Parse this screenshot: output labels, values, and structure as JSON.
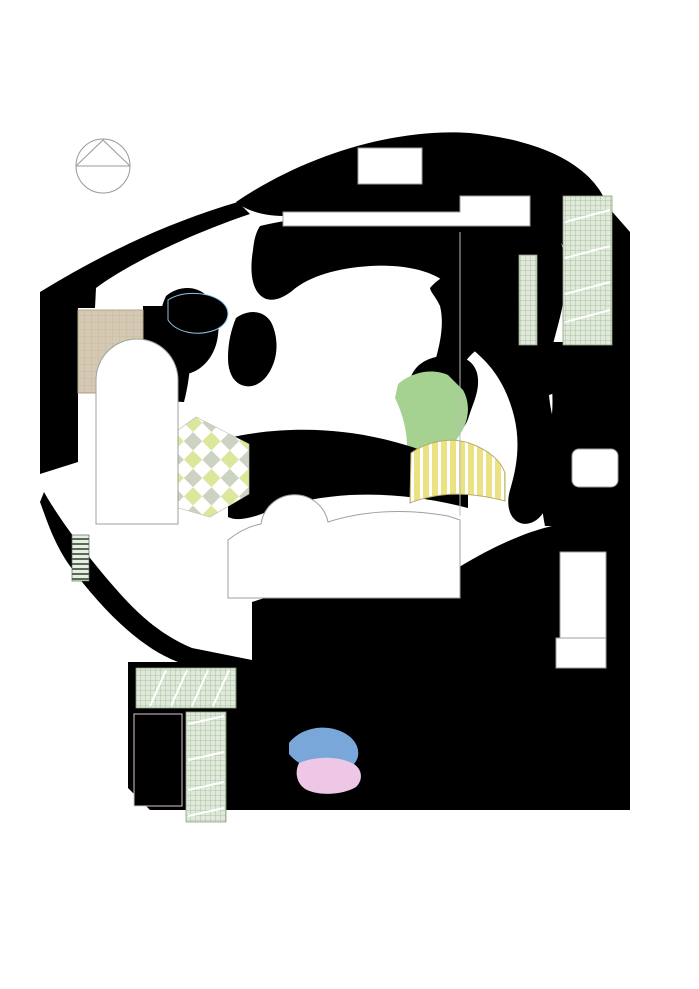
{
  "compass": {
    "label": "N"
  },
  "colors": {
    "lawn": "#d8edc2",
    "lawn2": "#e3f2d2",
    "pink": "#e9c2e2",
    "pink_light": "#f4e4f0",
    "salmon": "#e8aba0",
    "brick": "#b4756b",
    "blue": "#6f9ed6",
    "blue_light": "#bfe2f6",
    "green_band": "#b5d9a0",
    "yellow_pale": "#f4f0ba",
    "yellow_stripe": "#ece284",
    "orange_steps": "#e8b06e",
    "sand": "#d8c9a2",
    "plaza_gray": "#d8d2c5",
    "road": "#b4b4b4",
    "tree_fill": "#cfe763",
    "tree_stroke": "#7f923b",
    "shrub_fill": "#7cc144",
    "shrub_stroke": "#4a7d26",
    "bush_fill": "#5aa636",
    "car_green": "#33512f",
    "car_red": "#8c3c34",
    "car_white": "#f3f3f3"
  },
  "trees": [
    [
      252,
      186,
      21
    ],
    [
      216,
      198,
      21
    ],
    [
      182,
      212,
      21
    ],
    [
      149,
      228,
      21
    ],
    [
      117,
      244,
      21
    ],
    [
      86,
      260,
      20
    ],
    [
      57,
      277,
      20
    ],
    [
      44,
      308,
      20
    ],
    [
      42,
      346,
      20
    ],
    [
      41,
      384,
      20
    ],
    [
      42,
      422,
      20
    ],
    [
      45,
      459,
      20
    ],
    [
      50,
      494,
      20
    ],
    [
      63,
      524,
      19
    ],
    [
      82,
      553,
      19
    ],
    [
      103,
      581,
      19
    ],
    [
      125,
      607,
      19
    ],
    [
      147,
      632,
      18
    ],
    [
      176,
      642,
      15
    ],
    [
      204,
      649,
      15
    ],
    [
      240,
      666,
      16
    ],
    [
      260,
      703,
      17
    ],
    [
      288,
      171,
      22
    ],
    [
      325,
      158,
      22
    ],
    [
      362,
      148,
      22
    ],
    [
      400,
      141,
      22
    ],
    [
      438,
      138,
      22
    ],
    [
      476,
      141,
      22
    ],
    [
      512,
      150,
      21
    ],
    [
      545,
      164,
      21
    ],
    [
      574,
      183,
      20
    ],
    [
      597,
      207,
      19
    ],
    [
      615,
      232,
      14
    ],
    [
      617,
      257,
      14
    ],
    [
      618,
      282,
      14
    ],
    [
      619,
      307,
      14
    ],
    [
      620,
      331,
      14
    ],
    [
      620,
      357,
      16
    ],
    [
      620,
      383,
      16
    ],
    [
      619,
      409,
      16
    ],
    [
      617,
      435,
      16
    ],
    [
      615,
      461,
      16
    ],
    [
      613,
      487,
      16
    ],
    [
      611,
      513,
      16
    ],
    [
      616,
      560,
      18
    ],
    [
      618,
      586,
      18
    ],
    [
      620,
      612,
      18
    ],
    [
      621,
      637,
      18
    ],
    [
      620,
      663,
      18
    ],
    [
      618,
      688,
      18
    ],
    [
      630,
      724,
      18
    ],
    [
      642,
      756,
      18
    ],
    [
      652,
      788,
      18
    ],
    [
      243,
      807,
      19
    ],
    [
      281,
      807,
      19
    ],
    [
      319,
      807,
      19
    ],
    [
      357,
      807,
      19
    ],
    [
      395,
      807,
      19
    ],
    [
      433,
      807,
      19
    ],
    [
      471,
      807,
      19
    ],
    [
      509,
      807,
      19
    ],
    [
      547,
      807,
      19
    ],
    [
      585,
      807,
      19
    ],
    [
      621,
      806,
      19
    ],
    [
      155,
      856,
      20
    ],
    [
      193,
      856,
      20
    ],
    [
      231,
      856,
      20
    ],
    [
      269,
      856,
      20
    ],
    [
      307,
      856,
      20
    ],
    [
      345,
      856,
      20
    ],
    [
      383,
      856,
      20
    ],
    [
      421,
      856,
      20
    ],
    [
      459,
      856,
      20
    ],
    [
      497,
      856,
      20
    ],
    [
      535,
      856,
      20
    ],
    [
      573,
      856,
      20
    ],
    [
      611,
      856,
      20
    ],
    [
      648,
      857,
      20
    ],
    [
      627,
      884,
      16
    ],
    [
      37,
      668,
      16
    ],
    [
      30,
      704,
      16
    ],
    [
      28,
      740,
      16
    ],
    [
      31,
      776,
      16
    ],
    [
      52,
      800,
      16
    ],
    [
      78,
      823,
      17
    ],
    [
      105,
      842,
      17
    ],
    [
      130,
      852,
      17
    ]
  ],
  "shrubs": [
    [
      342,
      170,
      9
    ],
    [
      357,
      166,
      9
    ],
    [
      450,
      171,
      9
    ],
    [
      462,
      164,
      10
    ],
    [
      477,
      168,
      9
    ],
    [
      283,
      194,
      8
    ],
    [
      281,
      204,
      8
    ],
    [
      148,
      257,
      8
    ],
    [
      152,
      268,
      8
    ],
    [
      142,
      305,
      8
    ],
    [
      147,
      322,
      9
    ],
    [
      160,
      347,
      10
    ],
    [
      147,
      344,
      9
    ],
    [
      149,
      361,
      9
    ],
    [
      161,
      363,
      9
    ],
    [
      157,
      379,
      9
    ],
    [
      160,
      392,
      9
    ],
    [
      102,
      531,
      10
    ],
    [
      102,
      551,
      10
    ],
    [
      100,
      567,
      10
    ],
    [
      100,
      585,
      10
    ],
    [
      143,
      713,
      9
    ],
    [
      180,
      719,
      9
    ],
    [
      181,
      744,
      9
    ],
    [
      180,
      769,
      9
    ],
    [
      181,
      792,
      9
    ],
    [
      142,
      808,
      9
    ],
    [
      317,
      383,
      8
    ],
    [
      328,
      367,
      8
    ],
    [
      390,
      387,
      9
    ],
    [
      403,
      370,
      8
    ],
    [
      402,
      421,
      9
    ],
    [
      392,
      408,
      8
    ],
    [
      382,
      442,
      9
    ],
    [
      363,
      449,
      9
    ],
    [
      350,
      447,
      8
    ],
    [
      332,
      454,
      9
    ],
    [
      318,
      444,
      8
    ],
    [
      407,
      455,
      8
    ],
    [
      507,
      634,
      9
    ],
    [
      521,
      642,
      9
    ],
    [
      523,
      690,
      9
    ],
    [
      512,
      710,
      8
    ],
    [
      517,
      714,
      8
    ],
    [
      530,
      712,
      8
    ],
    [
      508,
      721,
      8
    ],
    [
      500,
      757,
      9
    ],
    [
      489,
      777,
      9
    ],
    [
      509,
      778,
      8
    ],
    [
      405,
      769,
      7
    ],
    [
      420,
      783,
      8
    ],
    [
      333,
      621,
      11
    ],
    [
      352,
      632,
      11
    ],
    [
      367,
      621,
      11
    ],
    [
      400,
      652,
      9
    ],
    [
      410,
      660,
      9
    ],
    [
      555,
      555,
      9
    ],
    [
      562,
      575,
      9
    ],
    [
      558,
      590,
      9
    ],
    [
      560,
      603,
      9
    ],
    [
      545,
      648,
      8
    ],
    [
      553,
      647,
      8
    ],
    [
      550,
      668,
      8
    ],
    [
      572,
      670,
      9
    ],
    [
      580,
      672,
      9
    ],
    [
      590,
      670,
      9
    ]
  ],
  "bushes": [
    [
      311,
      293,
      6
    ],
    [
      323,
      298,
      6
    ],
    [
      335,
      291,
      6
    ],
    [
      296,
      181,
      5
    ],
    [
      278,
      190,
      5
    ],
    [
      530,
      168,
      6
    ],
    [
      540,
      178,
      5
    ],
    [
      270,
      310,
      5
    ],
    [
      262,
      322,
      5
    ],
    [
      347,
      300,
      5
    ],
    [
      358,
      307,
      5
    ],
    [
      210,
      293,
      5
    ],
    [
      222,
      300,
      5
    ]
  ],
  "cars": [
    {
      "x": 589,
      "y": 233,
      "rot": 0,
      "color": "green"
    },
    {
      "x": 588,
      "y": 271,
      "rot": 0,
      "color": "red"
    },
    {
      "x": 590,
      "y": 307,
      "rot": 0,
      "color": "white"
    },
    {
      "x": 589,
      "y": 329,
      "rot": 0,
      "color": "red"
    },
    {
      "x": 157,
      "y": 687,
      "rot": 90,
      "color": "white"
    },
    {
      "x": 178,
      "y": 687,
      "rot": 90,
      "color": "green"
    },
    {
      "x": 198,
      "y": 687,
      "rot": 90,
      "color": "white"
    },
    {
      "x": 205,
      "y": 738,
      "rot": 0,
      "color": "red"
    },
    {
      "x": 206,
      "y": 777,
      "rot": 0,
      "color": "white"
    },
    {
      "x": 205,
      "y": 797,
      "rot": 0,
      "color": "green"
    }
  ],
  "stepping_stones": [
    [
      415,
      392
    ],
    [
      427,
      400
    ],
    [
      437,
      406
    ],
    [
      423,
      417
    ],
    [
      445,
      411
    ],
    [
      448,
      399
    ],
    [
      433,
      427
    ]
  ],
  "balls": [
    [
      343,
      388
    ],
    [
      369,
      381
    ],
    [
      334,
      413
    ],
    [
      352,
      419
    ]
  ],
  "blocks": [
    [
      440,
      622,
      0
    ],
    [
      453,
      620,
      1
    ],
    [
      466,
      618,
      2
    ],
    [
      479,
      620,
      1
    ],
    [
      492,
      624,
      0
    ],
    [
      430,
      634,
      1
    ],
    [
      444,
      634,
      2
    ],
    [
      458,
      632,
      0
    ],
    [
      472,
      630,
      1
    ],
    [
      486,
      632,
      2
    ],
    [
      424,
      646,
      2
    ],
    [
      438,
      648,
      0
    ],
    [
      452,
      646,
      1
    ],
    [
      466,
      644,
      0
    ],
    [
      480,
      646,
      2
    ],
    [
      494,
      648,
      1
    ],
    [
      432,
      660,
      0
    ],
    [
      446,
      662,
      1
    ],
    [
      460,
      660,
      2
    ],
    [
      474,
      658,
      0
    ],
    [
      488,
      660,
      1
    ],
    [
      426,
      674,
      1
    ],
    [
      440,
      676,
      2
    ],
    [
      454,
      674,
      0
    ],
    [
      468,
      672,
      1
    ],
    [
      497,
      666,
      0
    ],
    [
      418,
      658,
      2
    ],
    [
      412,
      672,
      0
    ],
    [
      420,
      688,
      1
    ],
    [
      482,
      688,
      2
    ]
  ],
  "block_colors": [
    "#b5493c",
    "#e8ddba",
    "#8a5a3c"
  ],
  "confetti_colors": [
    "#c0392b",
    "#27ae60",
    "#f1c40f",
    "#2980b9",
    "#e67e22",
    "#8e44ad",
    "#ecf0f1"
  ],
  "features": {
    "maze": {
      "cx": 232,
      "cy": 426,
      "r": 54,
      "rings": [
        46,
        38,
        30,
        22
      ]
    },
    "tent": {
      "cx": 347,
      "cy": 672,
      "r": 41
    },
    "plaza_circle": {
      "cx": 497,
      "cy": 671,
      "r": 33
    },
    "amphitheater": {
      "cx": 452,
      "cy": 752,
      "r": 38,
      "step_outer": 48,
      "step_inner": 34,
      "a0": -95,
      "a1": 115
    },
    "leaf_mosaic": {
      "cx": 296,
      "cy": 333
    },
    "eye_feature": {
      "cx": 362,
      "cy": 404
    },
    "play_equipment": [
      {
        "x": 243,
        "y": 352,
        "rot": 90
      },
      {
        "x": 293,
        "y": 678,
        "rot": 0
      },
      {
        "x": 347,
        "y": 716,
        "rot": 0
      },
      {
        "x": 331,
        "y": 764,
        "rot": 0
      }
    ],
    "fan_center": {
      "cx": 340,
      "cy": 640
    }
  }
}
